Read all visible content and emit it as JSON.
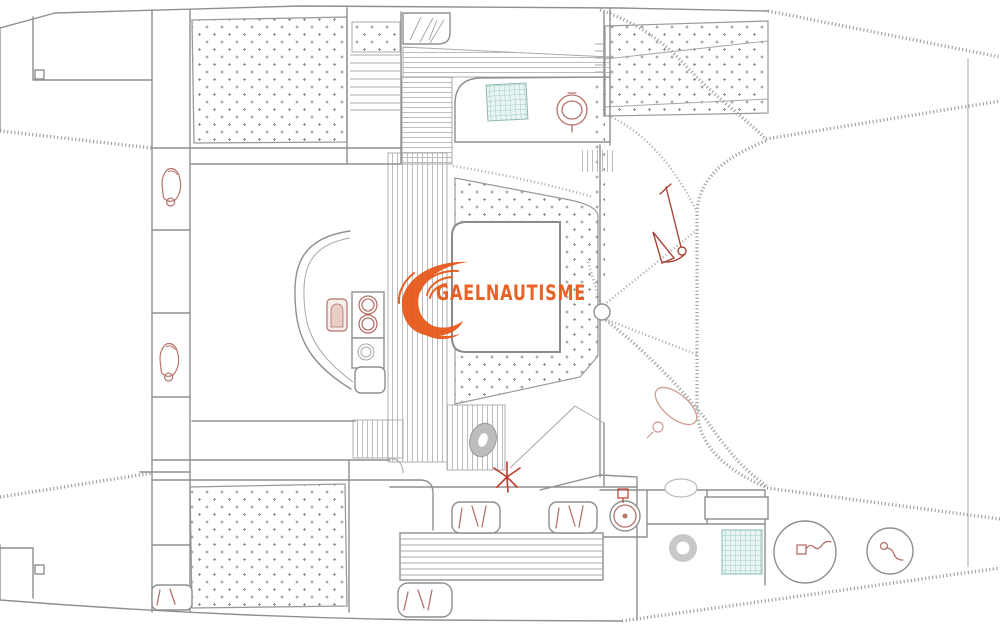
{
  "watermark": {
    "text": "GAELNAUTISME",
    "color": "#e7591b"
  },
  "drawing": {
    "kind": "catamaran-deck-plan",
    "colors": {
      "outline": "#8f8f8f",
      "pattern_dots": "#8a93a0",
      "stripes": "#bcbcbc",
      "teal_grid": "#8cc3bb",
      "fixture_red": "#b5736a",
      "accent_orange": "#e7591b"
    },
    "fixtures": [
      "toilet-icon",
      "toilet-icon",
      "stove-burner-icon",
      "oven-icon",
      "galley-sink-icon",
      "cockpit-sink-icon",
      "anchor-icon",
      "fender-icon",
      "compass-star-icon",
      "shower-tray-icon",
      "life-ring-icon",
      "round-table-icon",
      "round-table-icon",
      "hatch-grid-icon",
      "hatch-grid-icon",
      "mattress-area",
      "mattress-area",
      "dinette-seats",
      "bow-seats",
      "transom-steps",
      "trampoline-area"
    ]
  }
}
